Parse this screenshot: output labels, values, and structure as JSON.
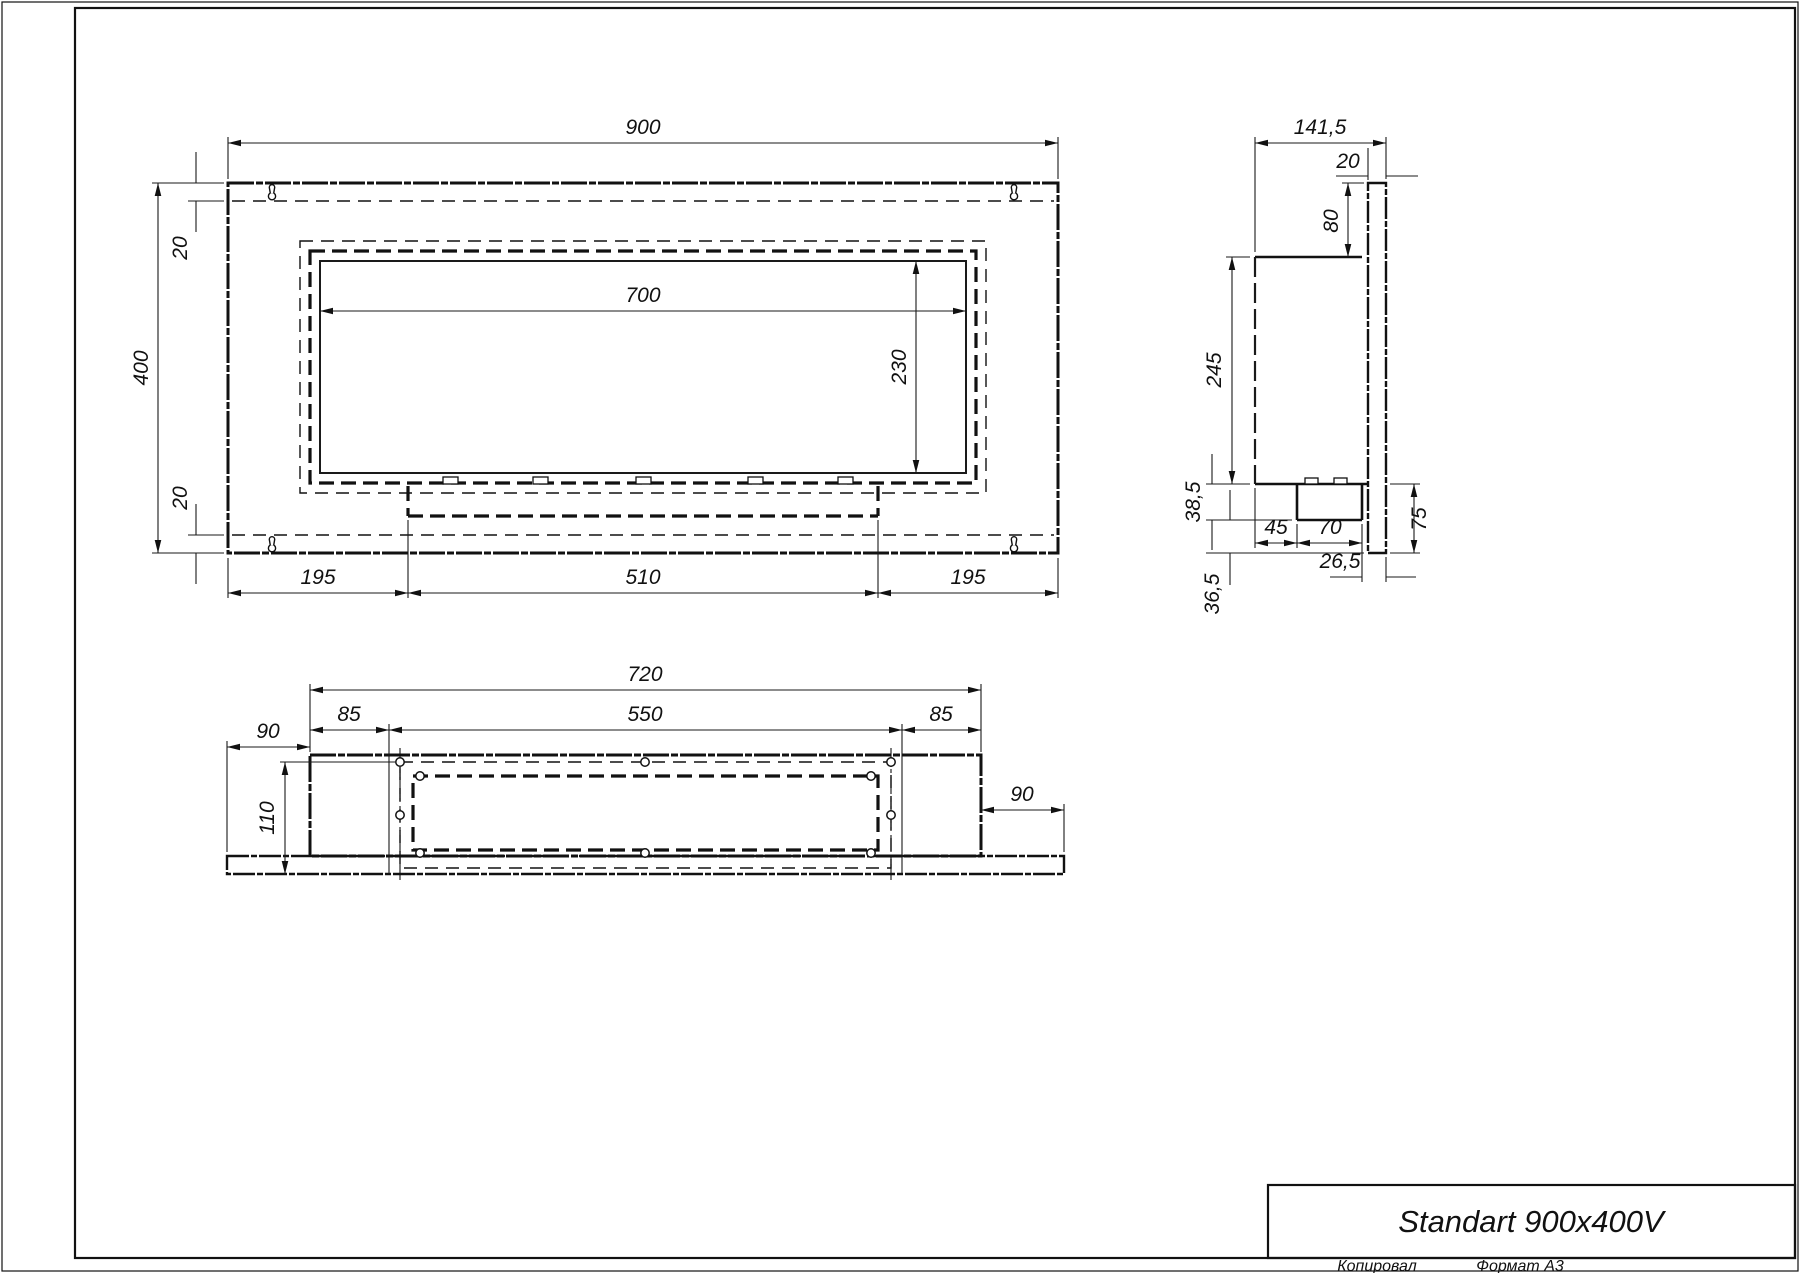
{
  "title_block": {
    "model": "Standart 900x400V"
  },
  "footer": {
    "copied": "Копировал",
    "format": "Формат А3"
  },
  "front_view": {
    "width": "900",
    "height": "400",
    "top_inset": "20",
    "bottom_inset": "20",
    "opening_width": "700",
    "opening_height": "230",
    "bottom_left": "195",
    "bottom_center": "510",
    "bottom_right": "195"
  },
  "side_view": {
    "depth": "141,5",
    "plate_thickness": "20",
    "top_to_body": "80",
    "body_height": "245",
    "tray_depth": "38,5",
    "below_tray": "36,5",
    "tray_offset": "45",
    "tray_width": "70",
    "plate_below_body": "75",
    "tray_to_plate": "26,5"
  },
  "bottom_view": {
    "body_width": "720",
    "inset_left": "85",
    "mount_width": "550",
    "inset_right": "85",
    "overhang_left": "90",
    "overhang_right": "90",
    "body_depth": "110"
  },
  "icons": {
    "mount": "keyhole-mount-icon"
  }
}
